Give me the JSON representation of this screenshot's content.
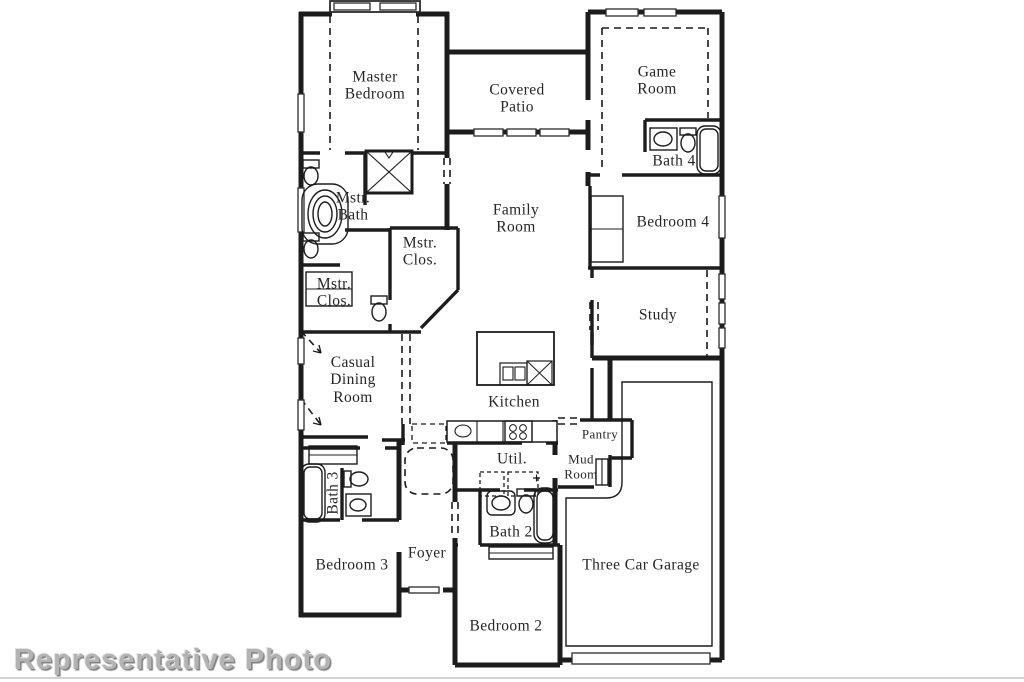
{
  "document_type": "floor-plan",
  "watermark": "Representative Photo",
  "rooms": {
    "master_bedroom": {
      "line1": "Master",
      "line2": "Bedroom"
    },
    "covered_patio": {
      "line1": "Covered",
      "line2": "Patio"
    },
    "game_room": {
      "line1": "Game",
      "line2": "Room"
    },
    "bath4": {
      "line1": "Bath 4"
    },
    "mstr_bath": {
      "line1": "Mstr.",
      "line2": "Bath"
    },
    "mstr_clos_right": {
      "line1": "Mstr.",
      "line2": "Clos."
    },
    "mstr_clos_left": {
      "line1": "Mstr.",
      "line2": "Clos."
    },
    "family_room": {
      "line1": "Family",
      "line2": "Room"
    },
    "bedroom4": {
      "line1": "Bedroom 4"
    },
    "study": {
      "line1": "Study"
    },
    "casual_dining": {
      "line1": "Casual",
      "line2": "Dining",
      "line3": "Room"
    },
    "kitchen": {
      "line1": "Kitchen"
    },
    "pantry": {
      "line1": "Pantry"
    },
    "mud_room": {
      "line1": "Mud",
      "line2": "Room"
    },
    "util": {
      "line1": "Util."
    },
    "bath2": {
      "line1": "Bath 2"
    },
    "bath3": {
      "line1": "Bath 3"
    },
    "foyer": {
      "line1": "Foyer"
    },
    "bedroom3": {
      "line1": "Bedroom 3"
    },
    "bedroom2": {
      "line1": "Bedroom 2"
    },
    "garage": {
      "line1": "Three Car Garage"
    }
  },
  "fixture_icons": [
    "bathtub",
    "shower",
    "toilet",
    "sink",
    "kitchen-island",
    "dishwasher",
    "stove",
    "washer-dryer",
    "closet",
    "pantry-door",
    "garage-door",
    "front-door",
    "window"
  ],
  "colors": {
    "wall": "#1c1c1c",
    "label": "#262626",
    "watermark": "#b3b3b3",
    "background": "#ffffff"
  }
}
